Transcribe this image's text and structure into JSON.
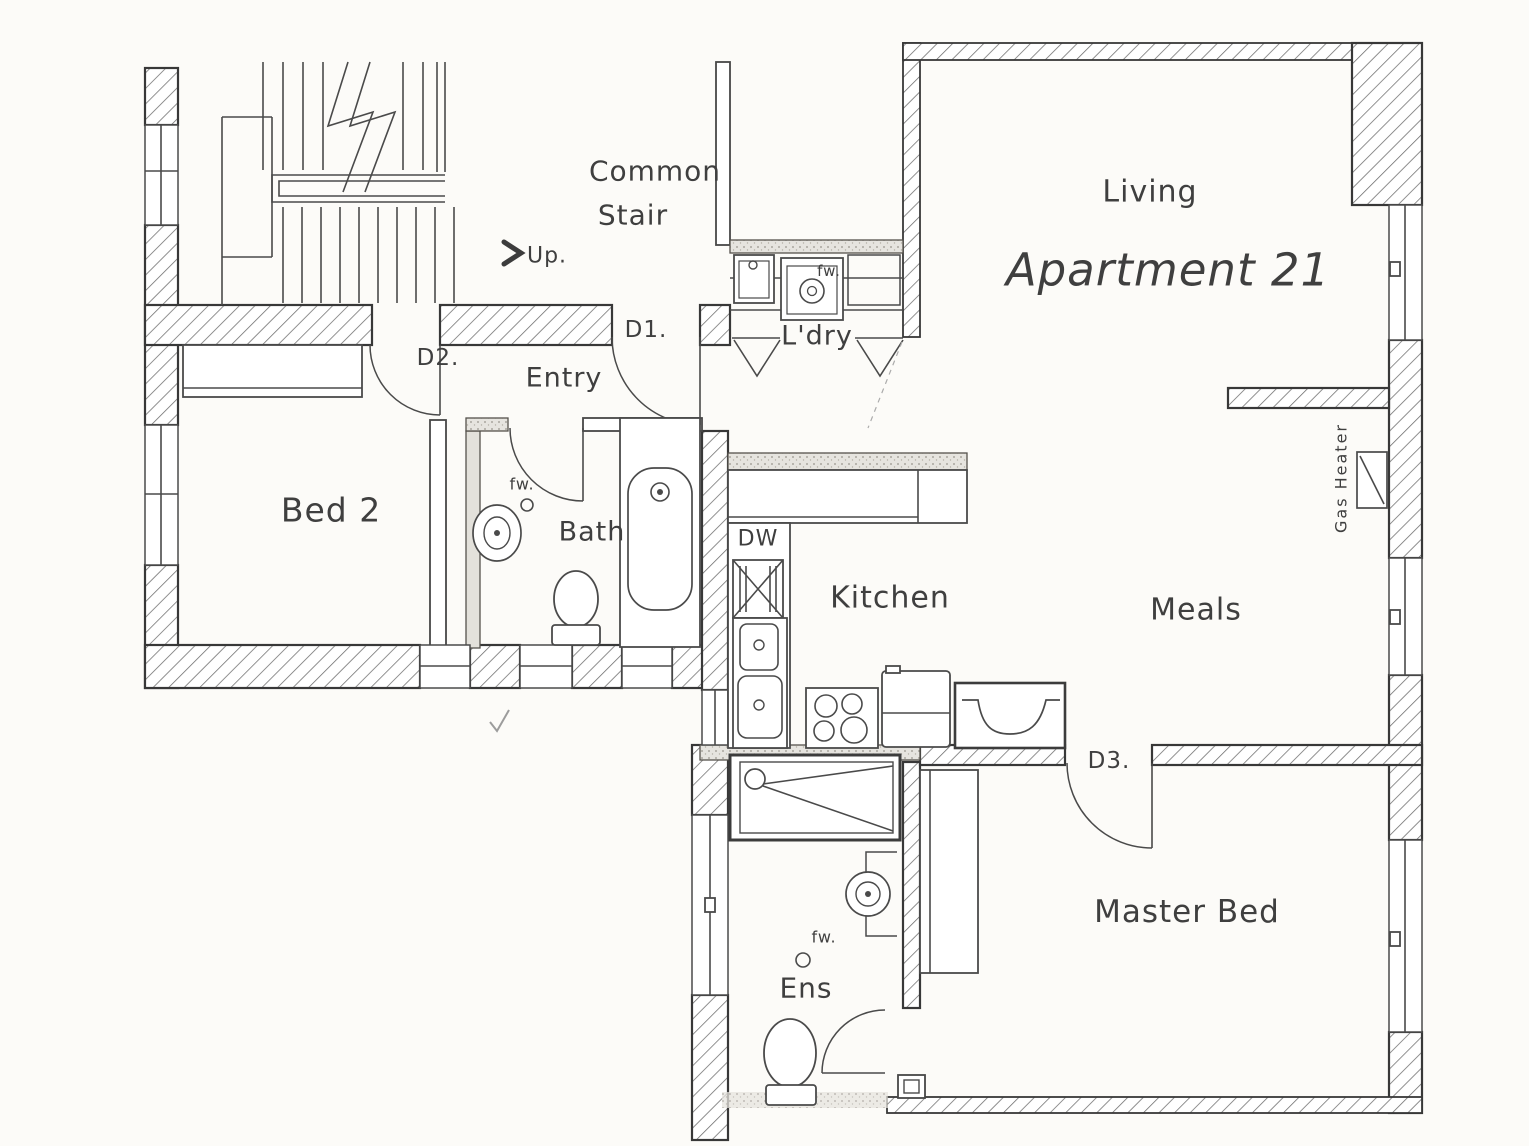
{
  "colors": {
    "paper": "#fcfbf8",
    "ink": "#3f3f3f"
  },
  "plan": {
    "unit_title": "Apartment 21",
    "rooms": {
      "living": "Living",
      "common_stair_line1": "Common",
      "common_stair_line2": "Stair",
      "entry": "Entry",
      "laundry": "L'dry",
      "bed2": "Bed 2",
      "bath": "Bath",
      "kitchen": "Kitchen",
      "meals": "Meals",
      "master_bed": "Master Bed",
      "ensuite": "Ens"
    },
    "doors": {
      "d1": "D1.",
      "d2": "D2.",
      "d3": "D3."
    },
    "annotations": {
      "up": "Up.",
      "dishwasher": "DW",
      "gas_heater": "Gas Heater",
      "floor_waste": "fw."
    }
  }
}
